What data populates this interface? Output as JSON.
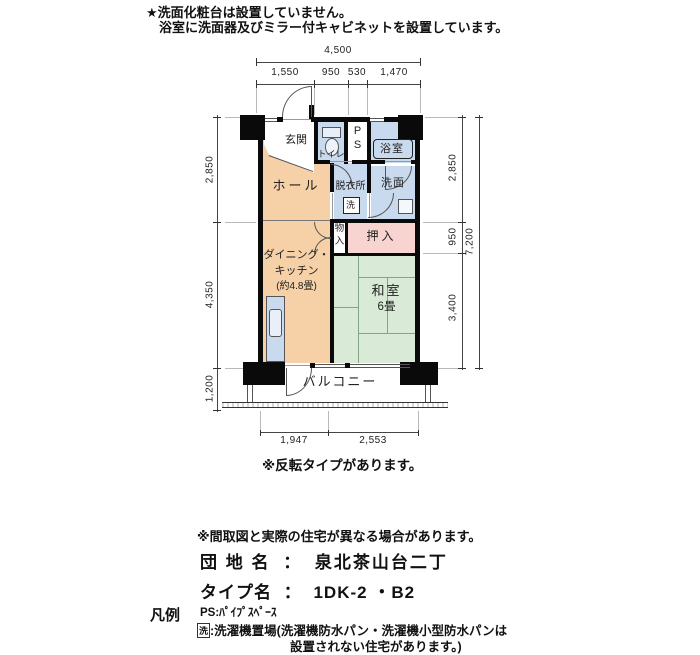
{
  "notes_top": {
    "line1": "★洗面化粧台は設置していません。",
    "line2": "浴室に洗面器及びミラー付キャビネットを設置しています。"
  },
  "floorplan": {
    "rooms": {
      "genkan": "玄関",
      "toilet": "トイレ",
      "ps_p": "P",
      "ps_s": "S",
      "bath": "浴室",
      "hall": "ホール",
      "datsuijo": "脱衣所",
      "senmen": "洗面",
      "washer": "洗",
      "monoire_l1": "物",
      "monoire_l2": "入",
      "oshiire": "押入",
      "dk_l1": "ダイニング・",
      "dk_l2": "キッチン",
      "dk_l3": "(約4.8畳)",
      "washitsu": "和室",
      "washitsu_size": "6畳",
      "balcony": "バルコニー"
    },
    "dimensions": {
      "top_total": "4,500",
      "top": [
        "1,550",
        "950",
        "530",
        "1,470"
      ],
      "left": [
        "2,850",
        "4,350",
        "1,200"
      ],
      "right": [
        "2,850",
        "950",
        "3,400"
      ],
      "right_total": "7,200",
      "bottom": [
        "1,947",
        "2,553"
      ]
    },
    "note_reverse": "※反転タイプがあります。"
  },
  "footer": {
    "disclaimer": "※間取図と実際の住宅が異なる場合があります。",
    "danchi_label": "団 地 名",
    "colon": "：",
    "danchi_name": "泉北茶山台二丁",
    "type_label": "タイプ名",
    "type_value": "1DK-2 ・B2",
    "legend_title": "凡例",
    "legend_ps": "PS:ﾊﾟｲﾌﾟｽﾍﾟｰｽ",
    "legend_washer_symbol": "洗",
    "legend_washer_line1": ":洗濯機置場(洗濯機防水パン・洗濯機小型防水パンは",
    "legend_washer_line2": "設置されない住宅があります。)"
  },
  "colors": {
    "room_orange": "#f6d0a7",
    "room_blue": "#c9daee",
    "room_green": "#d9ebd7",
    "room_pink": "#f8d4d0",
    "wall_black": "#0a0a0a"
  }
}
